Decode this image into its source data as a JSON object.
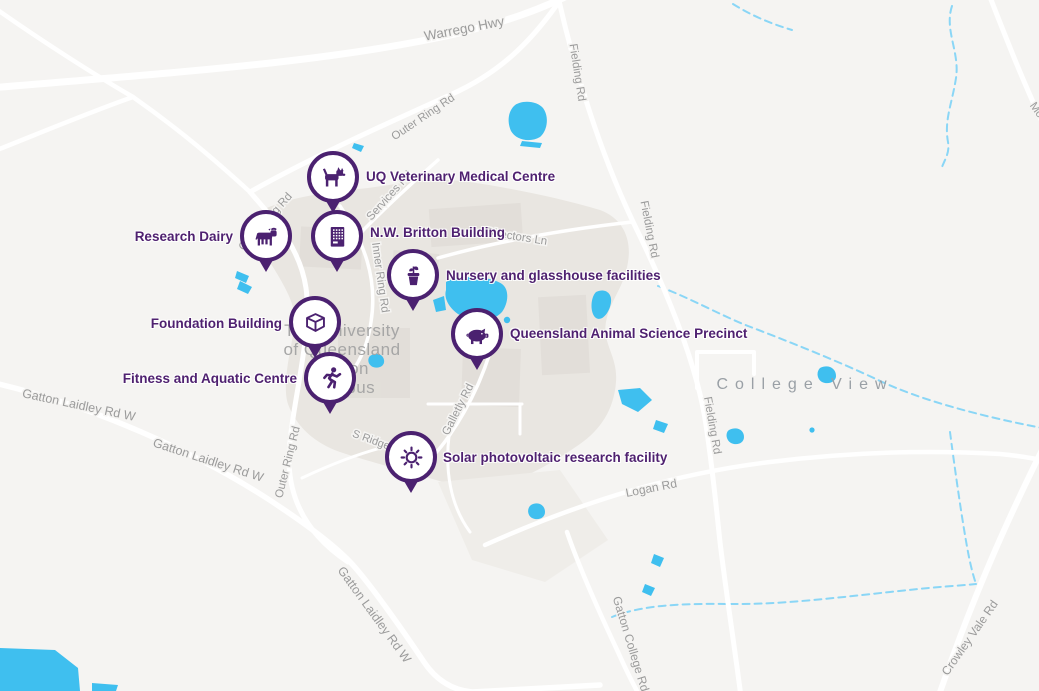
{
  "colors": {
    "marker_purple": "#4b2170",
    "label_purple": "#4f2170",
    "water_blue": "#3fbfef",
    "creek_blue": "#8ad6f6",
    "road_white": "#ffffff",
    "road_label_gray": "#9b9b9b",
    "campus_gray": "#e9e6e1",
    "background_gray": "#f5f4f2"
  },
  "campus_label": {
    "lines": [
      "The University",
      "of Queensland",
      "Gatton",
      "Campus"
    ]
  },
  "area_label": "College View",
  "markers": [
    {
      "id": "uq-veterinary-medical-centre",
      "icon": "dog-icon",
      "label": "UQ Veterinary Medical Centre",
      "label_side": "right"
    },
    {
      "id": "research-dairy",
      "icon": "cow-icon",
      "label": "Research Dairy",
      "label_side": "left"
    },
    {
      "id": "nw-britton-building",
      "icon": "building-icon",
      "label": "N.W. Britton Building",
      "label_side": "right"
    },
    {
      "id": "nursery-and-glasshouse-facilities",
      "icon": "plant-pot-icon",
      "label": "Nursery and glasshouse facilities",
      "label_side": "right"
    },
    {
      "id": "foundation-building",
      "icon": "cube-icon",
      "label": "Foundation Building",
      "label_side": "left"
    },
    {
      "id": "queensland-animal-science-precinct",
      "icon": "pig-icon",
      "label": "Queensland Animal Science Precinct",
      "label_side": "right"
    },
    {
      "id": "fitness-and-aquatic-centre",
      "icon": "runner-icon",
      "label": "Fitness and Aquatic Centre",
      "label_side": "left"
    },
    {
      "id": "solar-photovoltaic-research-facility",
      "icon": "sun-icon",
      "label": "Solar photovoltaic research facility",
      "label_side": "right"
    }
  ],
  "road_labels": [
    {
      "label": "Warrego Hwy"
    },
    {
      "label": "Fielding Rd"
    },
    {
      "label": "Outer Ring Rd"
    },
    {
      "label": "Outer Ring Rd"
    },
    {
      "label": "Outer Ring Rd"
    },
    {
      "label": "Inner Ring Rd"
    },
    {
      "label": "Services Rd"
    },
    {
      "label": "Directors Ln"
    },
    {
      "label": "Fielding Rd"
    },
    {
      "label": "Fielding Rd"
    },
    {
      "label": "Gatton Laidley Rd W"
    },
    {
      "label": "Gatton Laidley Rd W"
    },
    {
      "label": "Gatton Laidley Rd W"
    },
    {
      "label": "S Ridge Rd"
    },
    {
      "label": "Galletly Rd"
    },
    {
      "label": "Logan Rd"
    },
    {
      "label": "Gatton College Rd"
    },
    {
      "label": "Crowley Vale Rd"
    },
    {
      "label": "Mo"
    }
  ]
}
